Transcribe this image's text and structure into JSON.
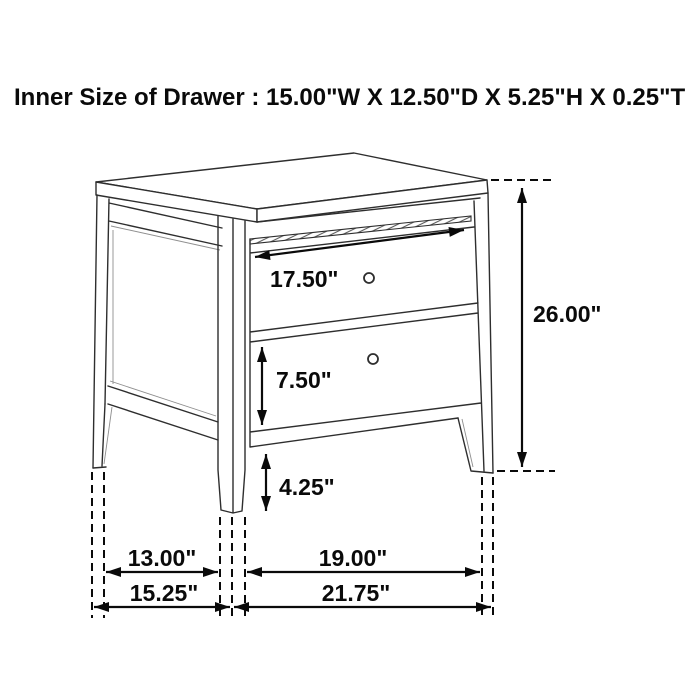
{
  "header": {
    "title": "Inner Size of Drawer : 15.00\"W X 12.50\"D X 5.25\"H X 0.25\"T"
  },
  "diagram": {
    "dimension_labels": {
      "top_drawer_width": "17.50\"",
      "bottom_drawer_height": "7.50\"",
      "leg_height": "4.25\"",
      "overall_height": "26.00\"",
      "side_foot_span": "13.00\"",
      "front_foot_span": "19.00\"",
      "overall_depth": "15.25\"",
      "overall_width": "21.75\""
    },
    "colors": {
      "background": "#ffffff",
      "artwork_line": "#2e2e2e",
      "dimension_line": "#0a0a0a"
    }
  }
}
